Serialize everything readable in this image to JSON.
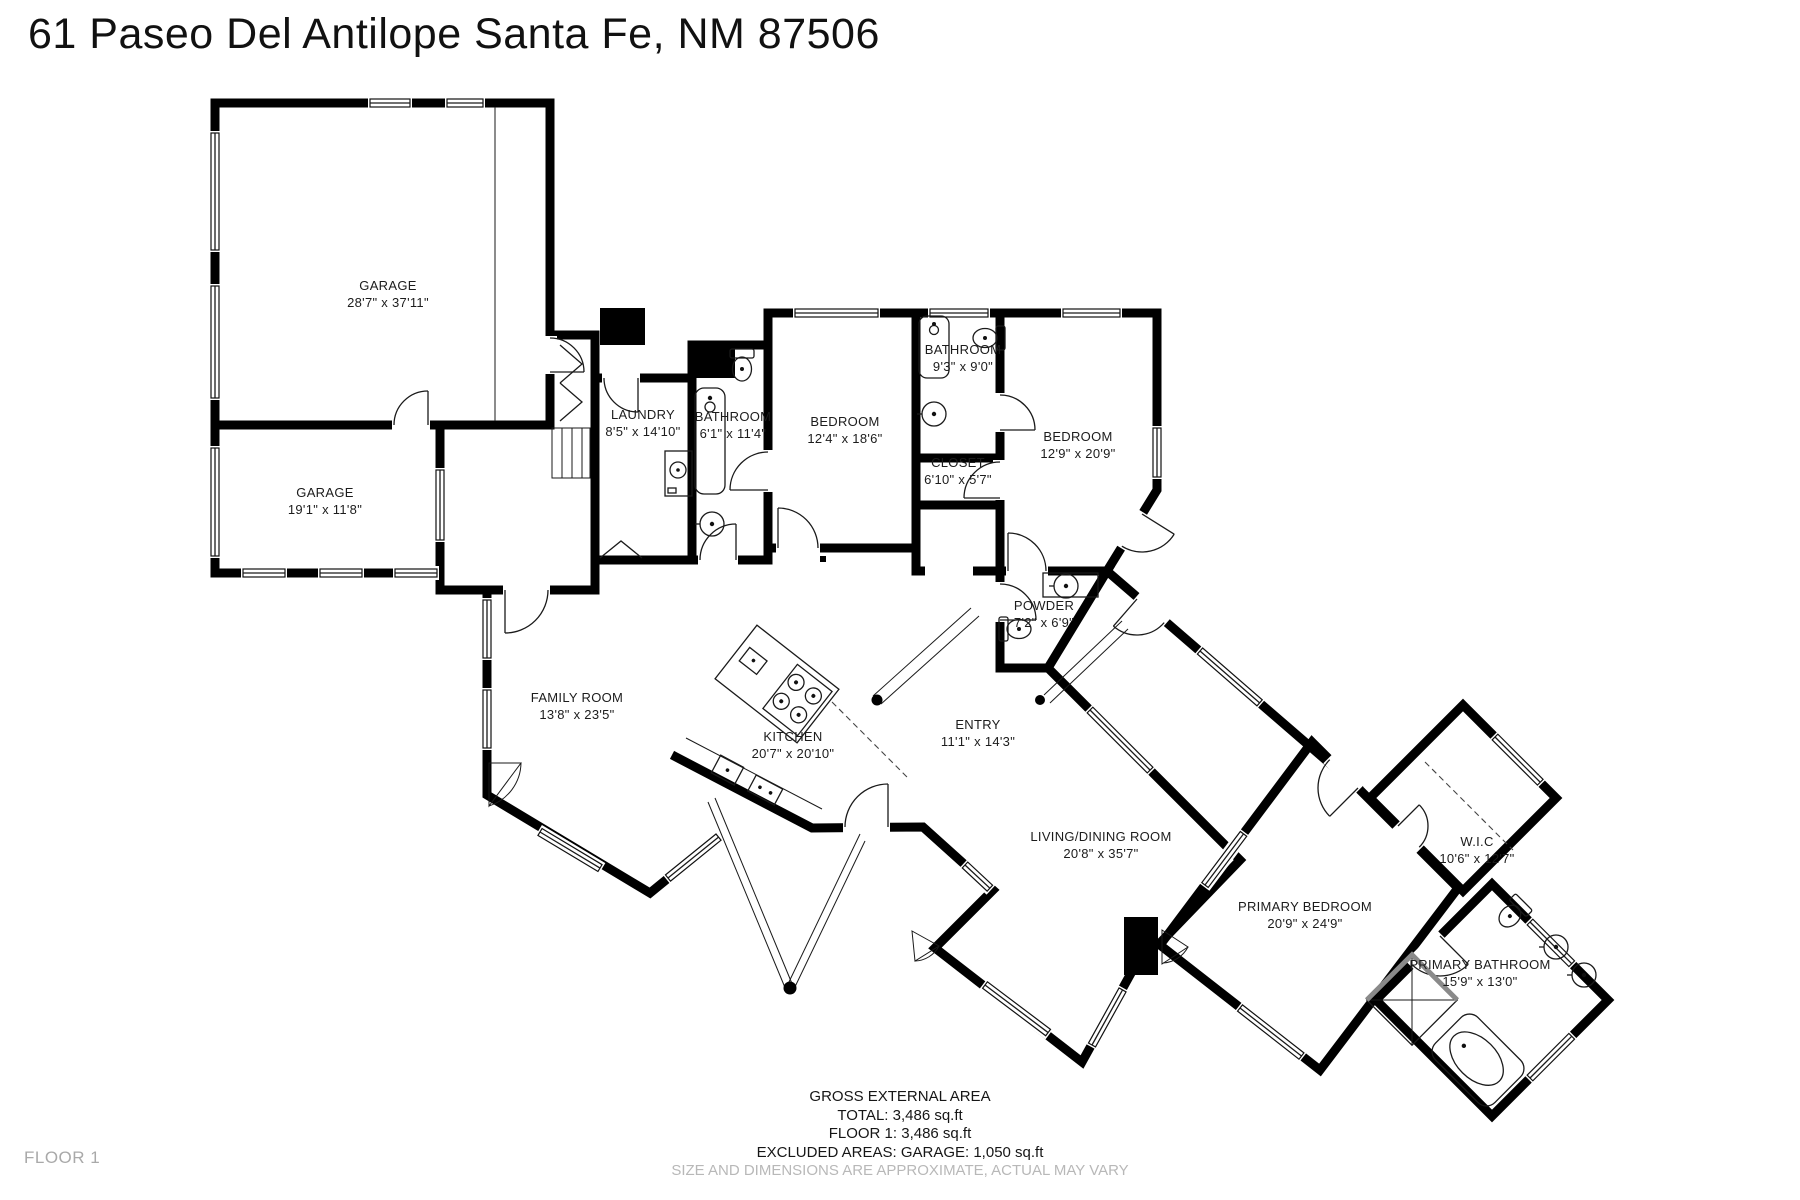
{
  "title": "61 Paseo Del Antilope Santa Fe, NM 87506",
  "floor_label": "FLOOR 1",
  "rooms": [
    {
      "id": "garage-1",
      "name": "GARAGE",
      "dims": "28'7\" x 37'11\""
    },
    {
      "id": "garage-2",
      "name": "GARAGE",
      "dims": "19'1\" x 11'8\""
    },
    {
      "id": "laundry",
      "name": "LAUNDRY",
      "dims": "8'5\" x 14'10\""
    },
    {
      "id": "bathroom-1",
      "name": "BATHROOM",
      "dims": "6'1\" x 11'4\""
    },
    {
      "id": "bedroom-1",
      "name": "BEDROOM",
      "dims": "12'4\" x 18'6\""
    },
    {
      "id": "bathroom-2",
      "name": "BATHROOM",
      "dims": "9'3\" x 9'0\""
    },
    {
      "id": "closet",
      "name": "CLOSET",
      "dims": "6'10\" x 5'7\""
    },
    {
      "id": "bedroom-2",
      "name": "BEDROOM",
      "dims": "12'9\" x 20'9\""
    },
    {
      "id": "powder",
      "name": "POWDER",
      "dims": "7'2\" x 6'9\""
    },
    {
      "id": "family-room",
      "name": "FAMILY ROOM",
      "dims": "13'8\" x 23'5\""
    },
    {
      "id": "kitchen",
      "name": "KITCHEN",
      "dims": "20'7\" x 20'10\""
    },
    {
      "id": "entry",
      "name": "ENTRY",
      "dims": "11'1\" x 14'3\""
    },
    {
      "id": "living-dining",
      "name": "LIVING/DINING ROOM",
      "dims": "20'8\" x 35'7\""
    },
    {
      "id": "primary-bedroom",
      "name": "PRIMARY BEDROOM",
      "dims": "20'9\" x 24'9\""
    },
    {
      "id": "wic",
      "name": "W.I.C",
      "dims": "10'6\" x 12'7\""
    },
    {
      "id": "primary-bathroom",
      "name": "PRIMARY BATHROOM",
      "dims": "15'9\" x 13'0\""
    }
  ],
  "summary": {
    "heading": "GROSS EXTERNAL AREA",
    "total": "TOTAL: 3,486 sq.ft",
    "floor1": "FLOOR 1: 3,486 sq.ft",
    "excluded": "EXCLUDED AREAS: GARAGE: 1,050 sq.ft",
    "disclaimer": "SIZE AND DIMENSIONS ARE APPROXIMATE, ACTUAL MAY VARY"
  },
  "colors": {
    "wall": "#000000",
    "label": "#1c1c1c",
    "muted": "#b8b8b8"
  }
}
